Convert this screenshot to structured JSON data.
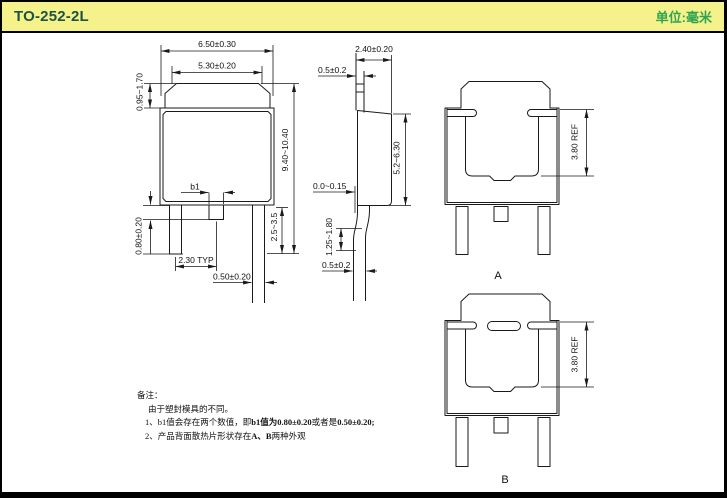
{
  "header": {
    "title": "TO-252-2L",
    "unit_label": "单位:毫米"
  },
  "colors": {
    "header_bg": "#f5f28c",
    "header_title": "#1d5244",
    "header_unit": "#2fa352",
    "line": "#1a1a1a"
  },
  "front_view": {
    "dim_body_width_outer": "6.50±0.30",
    "dim_tab_width": "5.30±0.20",
    "dim_tab_height": "0.95~1.70",
    "dim_total_height": "9.40~10.40",
    "dim_lead_length": "2.5~3.5",
    "label_b1": "b1",
    "dim_center_lead_length": "0.80±0.20",
    "dim_lead_pitch": "2.30 TYP",
    "dim_lead_width": "0.50±0.20"
  },
  "side_view": {
    "dim_body_thickness": "2.40±0.20",
    "dim_tab_thickness": "0.5±0.2",
    "dim_body_height": "5.2~6.30",
    "dim_standoff": "0.0~0.15",
    "dim_lead_bend_height": "1.25~1.80",
    "dim_lead_thickness": "0.5±0.2"
  },
  "rear_view_a": {
    "label": "A",
    "dim_pad_height": "3.80 REF"
  },
  "rear_view_b": {
    "label": "B",
    "dim_pad_height": "3.80 REF"
  },
  "notes": {
    "heading": "备注：",
    "intro": "由于塑封模具的不同。",
    "item1_prefix": "1、b1值会存在两个数值，即",
    "item1_bold1": "b1值为0.80±0.20",
    "item1_mid": "或者是",
    "item1_bold2": "0.50±0.20;",
    "item2_prefix": "2、产品背面散热片形状存在",
    "item2_bold": "A、B",
    "item2_suffix": "两种外观"
  }
}
